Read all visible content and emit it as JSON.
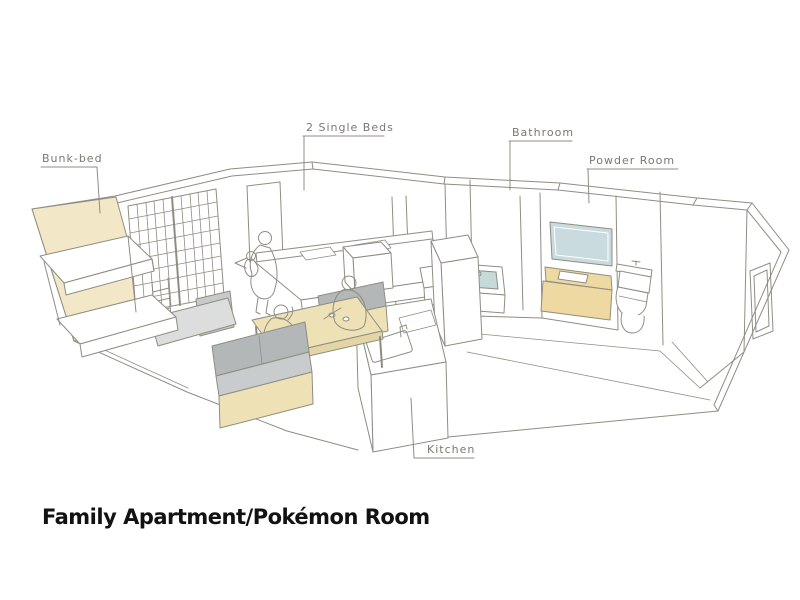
{
  "page": {
    "caption": "Family Apartment/Pokémon Room",
    "background": "#ffffff"
  },
  "labels": {
    "bunk_bed": "Bunk-bed",
    "single_beds": "2 Single Beds",
    "bathroom": "Bathroom",
    "powder_room": "Powder Room",
    "kitchen": "Kitchen"
  },
  "colors": {
    "line": "#8f8d83",
    "label_text": "#7a786f",
    "wall_tan": "#f2e7c6",
    "furniture_tan": "#efe1b6",
    "table_edge": "#e4d5a6",
    "vanity_tan": "#edd9a1",
    "water_blue": "#c6dad7",
    "mirror_blue": "#c9dbdf",
    "cushion_gray": "#b4b7b8",
    "seat_gray": "#c9cccc",
    "floor_gray": "#dcdedd",
    "panel_gray": "#c7cac9",
    "caption_color": "#121212"
  },
  "scene": {
    "rooms": [
      "pokemon-bedroom",
      "living-area",
      "kitchen",
      "bathroom",
      "powder-room",
      "entrance"
    ],
    "furniture": [
      "bunk-bed",
      "display-grid-wall",
      "ladder-shelf",
      "two-single-beds",
      "bed-cabinet",
      "large-sofa",
      "small-sofa",
      "low-table",
      "kitchen-island-with-sink",
      "tall-kitchen-unit",
      "bathtub",
      "bath-step",
      "vanity-with-mirror",
      "toilet"
    ],
    "people": [
      "parent-with-baby-on-bed",
      "person-on-sofa",
      "person-at-table"
    ]
  }
}
